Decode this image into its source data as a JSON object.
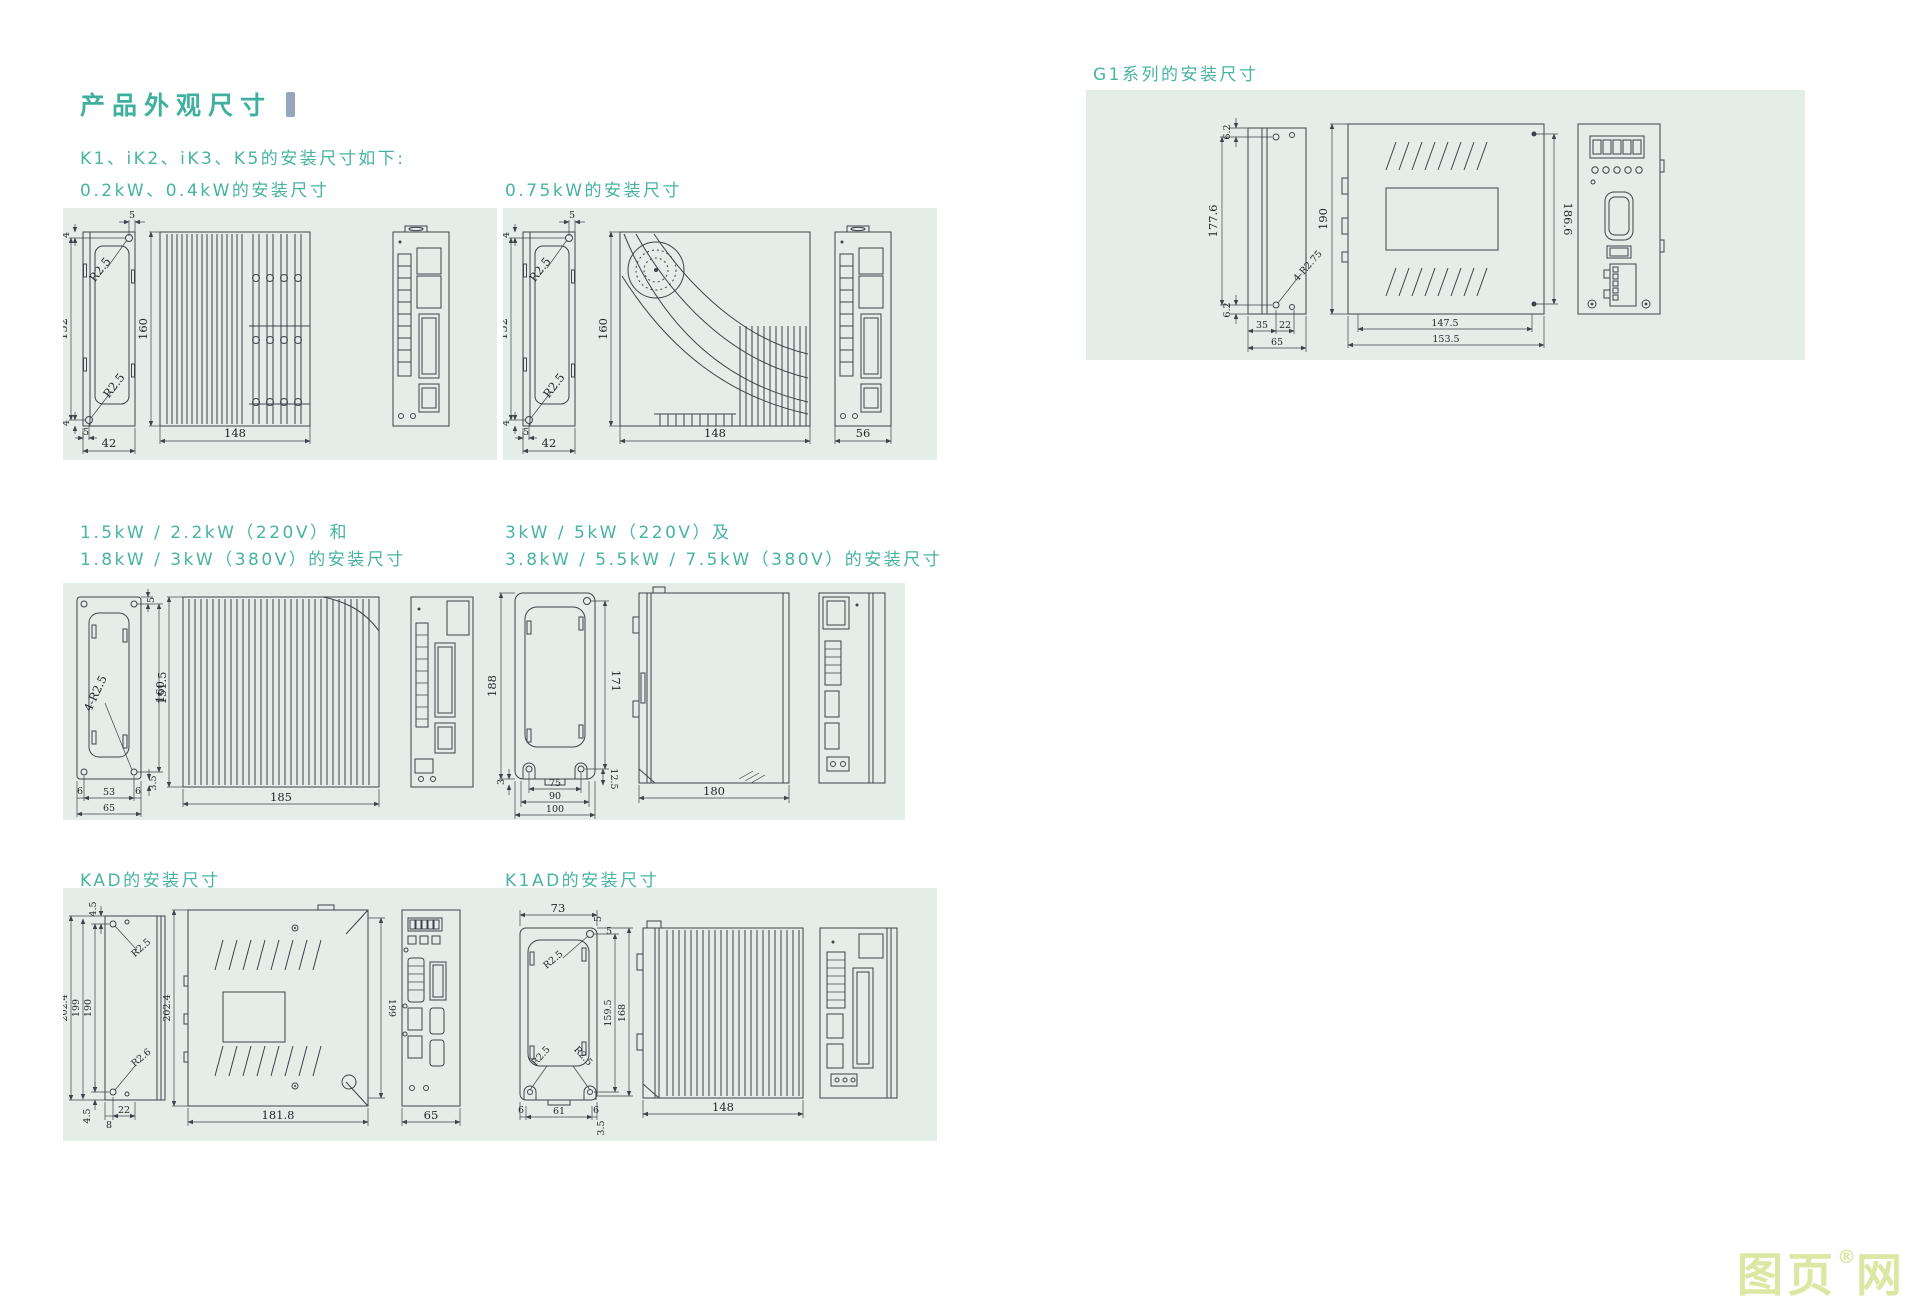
{
  "page": {
    "title": "产品外观尺寸",
    "intro": "K1、iK2、iK3、K5的安装尺寸如下:",
    "watermark_left": "图页",
    "watermark_reg": "®",
    "watermark_right": "网"
  },
  "p02": {
    "caption": "0.2kW、0.4kW的安装尺寸",
    "d4t": "4",
    "d5t": "5",
    "rt": "R2.5",
    "h": "152",
    "rb": "R2.5",
    "d4b": "4",
    "d5b": "5",
    "w": "42",
    "fh": "160",
    "fw": "148"
  },
  "p075": {
    "caption": "0.75kW的安装尺寸",
    "d4t": "4",
    "d5t": "5",
    "rt": "R2.5",
    "h": "152",
    "rb": "R2.5",
    "d4b": "4",
    "d5b": "5",
    "w": "42",
    "fh": "160",
    "fw": "148",
    "bw": "56"
  },
  "g1": {
    "caption": "G1系列的安装尺寸",
    "t62": "6.2",
    "h1776": "177.6",
    "b62": "6.2",
    "r": "4-R2.75",
    "d35": "35",
    "d22": "22",
    "d65": "65",
    "h190": "190",
    "w1475": "147.5",
    "w1535": "153.5",
    "h1866": "186.6"
  },
  "p15": {
    "cap1": "1.5kW / 2.2kW（220V）和",
    "cap2": "1.8kW / 3kW（380V）的安装尺寸",
    "d5": "5",
    "h1515": "151.5",
    "r": "4-R2.5",
    "d6a": "6",
    "d53": "53",
    "d6b": "6",
    "d65": "65",
    "d35": "3.5",
    "fh": "160",
    "fw": "185"
  },
  "p3k": {
    "cap1": "3kW / 5kW（220V）及",
    "cap2": "3.8kW / 5.5kW / 7.5kW（380V）的安装尺寸",
    "h188": "188",
    "h171": "171",
    "d3": "3",
    "d75": "75",
    "d90": "90",
    "d100": "100",
    "d125": "12.5",
    "w180": "180"
  },
  "kad": {
    "caption": "KAD的安装尺寸",
    "t45": "4.5",
    "h2024": "202.4",
    "h199": "199",
    "h190": "190",
    "rt": "R2.5",
    "rb": "R2.6",
    "d8": "8",
    "d22": "22",
    "b45": "4.5",
    "mh": "202.4",
    "mr": "199",
    "mw": "181.8",
    "bw": "65"
  },
  "k1ad": {
    "caption": "K1AD的安装尺寸",
    "w73": "73",
    "d5a": "5",
    "d5b": "5",
    "rt": "R2.5",
    "h1595": "159.5",
    "h168": "168",
    "rbl": "R2.5",
    "rbr": "R2.5",
    "d6a": "6",
    "d61": "61",
    "d6b": "6",
    "d35": "3.5",
    "fw": "148"
  }
}
